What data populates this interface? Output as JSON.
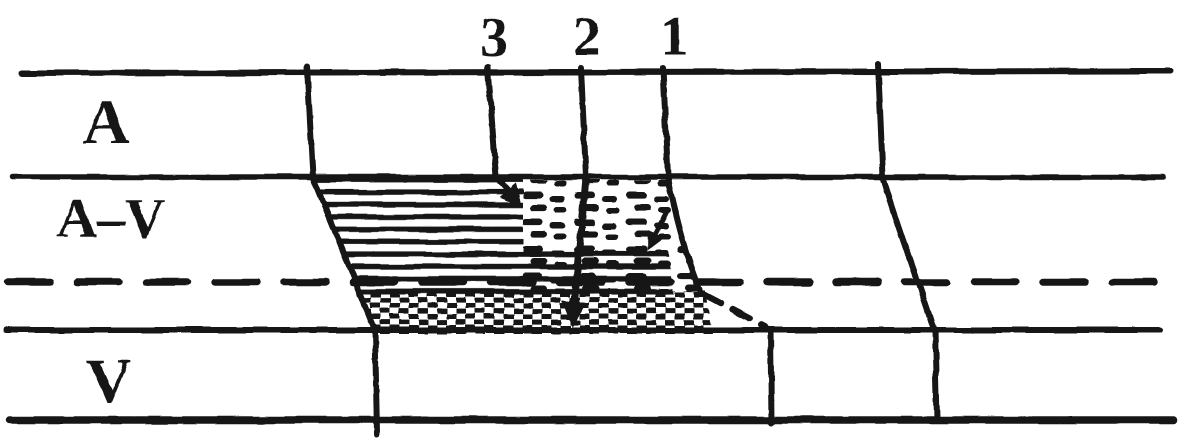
{
  "figure": {
    "kind": "cardiac-ladder-diagram",
    "paper_color": "#ffffff",
    "ink_color": "#151515",
    "row_labels": [
      {
        "id": "atrial-tier",
        "label": "A"
      },
      {
        "id": "av-junction-tier",
        "label": "A–V"
      },
      {
        "id": "ventricular-tier",
        "label": "V"
      }
    ],
    "beat_numbers": [
      {
        "id": "beat-3",
        "label": "3"
      },
      {
        "id": "beat-2",
        "label": "2"
      },
      {
        "id": "beat-1",
        "label": "1"
      }
    ]
  }
}
